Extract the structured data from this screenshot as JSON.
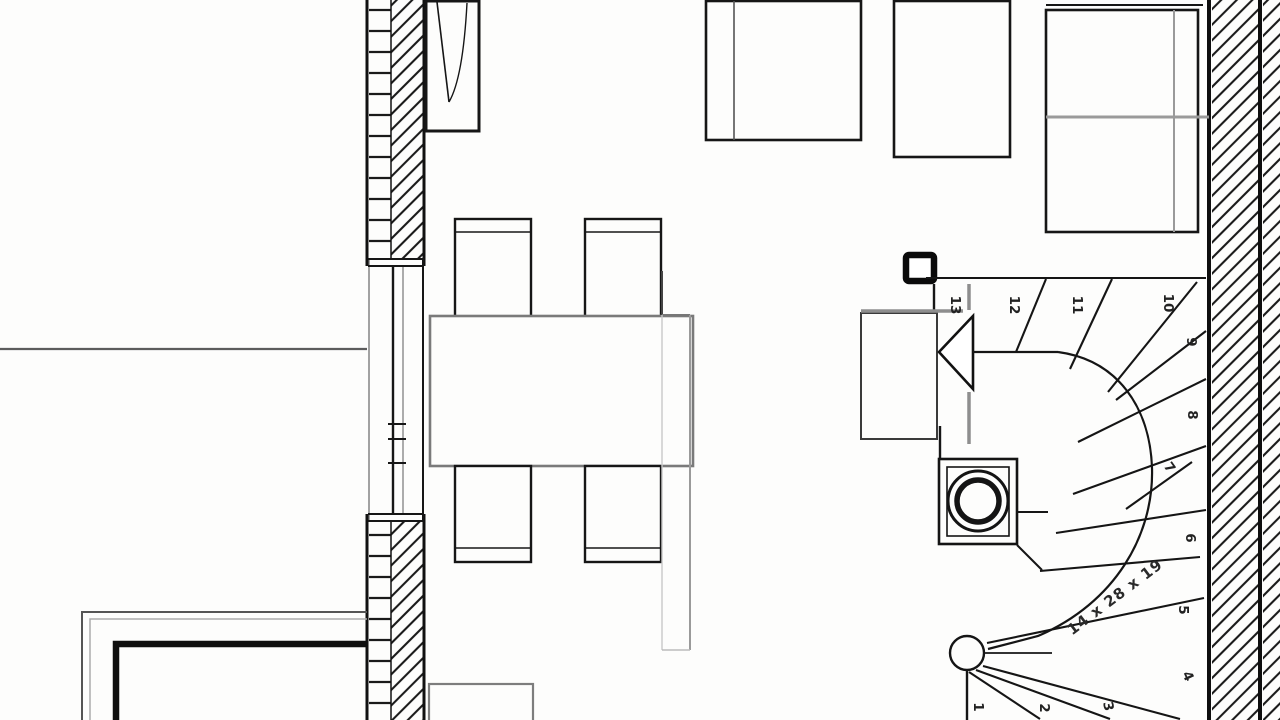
{
  "drawing": {
    "kind": "architectural floor plan (ground floor), black-line CAD drawing",
    "rooms_visible": "open living/dining room with winder staircase at lower right"
  },
  "colors": {
    "ink": "#161616",
    "gray": "#8e8e8e",
    "paper": "#fdfdfc"
  },
  "stairs": {
    "annotation": "14 x 28 x 19",
    "steps": [
      {
        "label": "1"
      },
      {
        "label": "2"
      },
      {
        "label": "3"
      },
      {
        "label": "4"
      },
      {
        "label": "5"
      },
      {
        "label": "6"
      },
      {
        "label": "7"
      },
      {
        "label": "8"
      },
      {
        "label": "9"
      },
      {
        "label": "10"
      },
      {
        "label": "11"
      },
      {
        "label": "12"
      },
      {
        "label": "13"
      }
    ]
  }
}
